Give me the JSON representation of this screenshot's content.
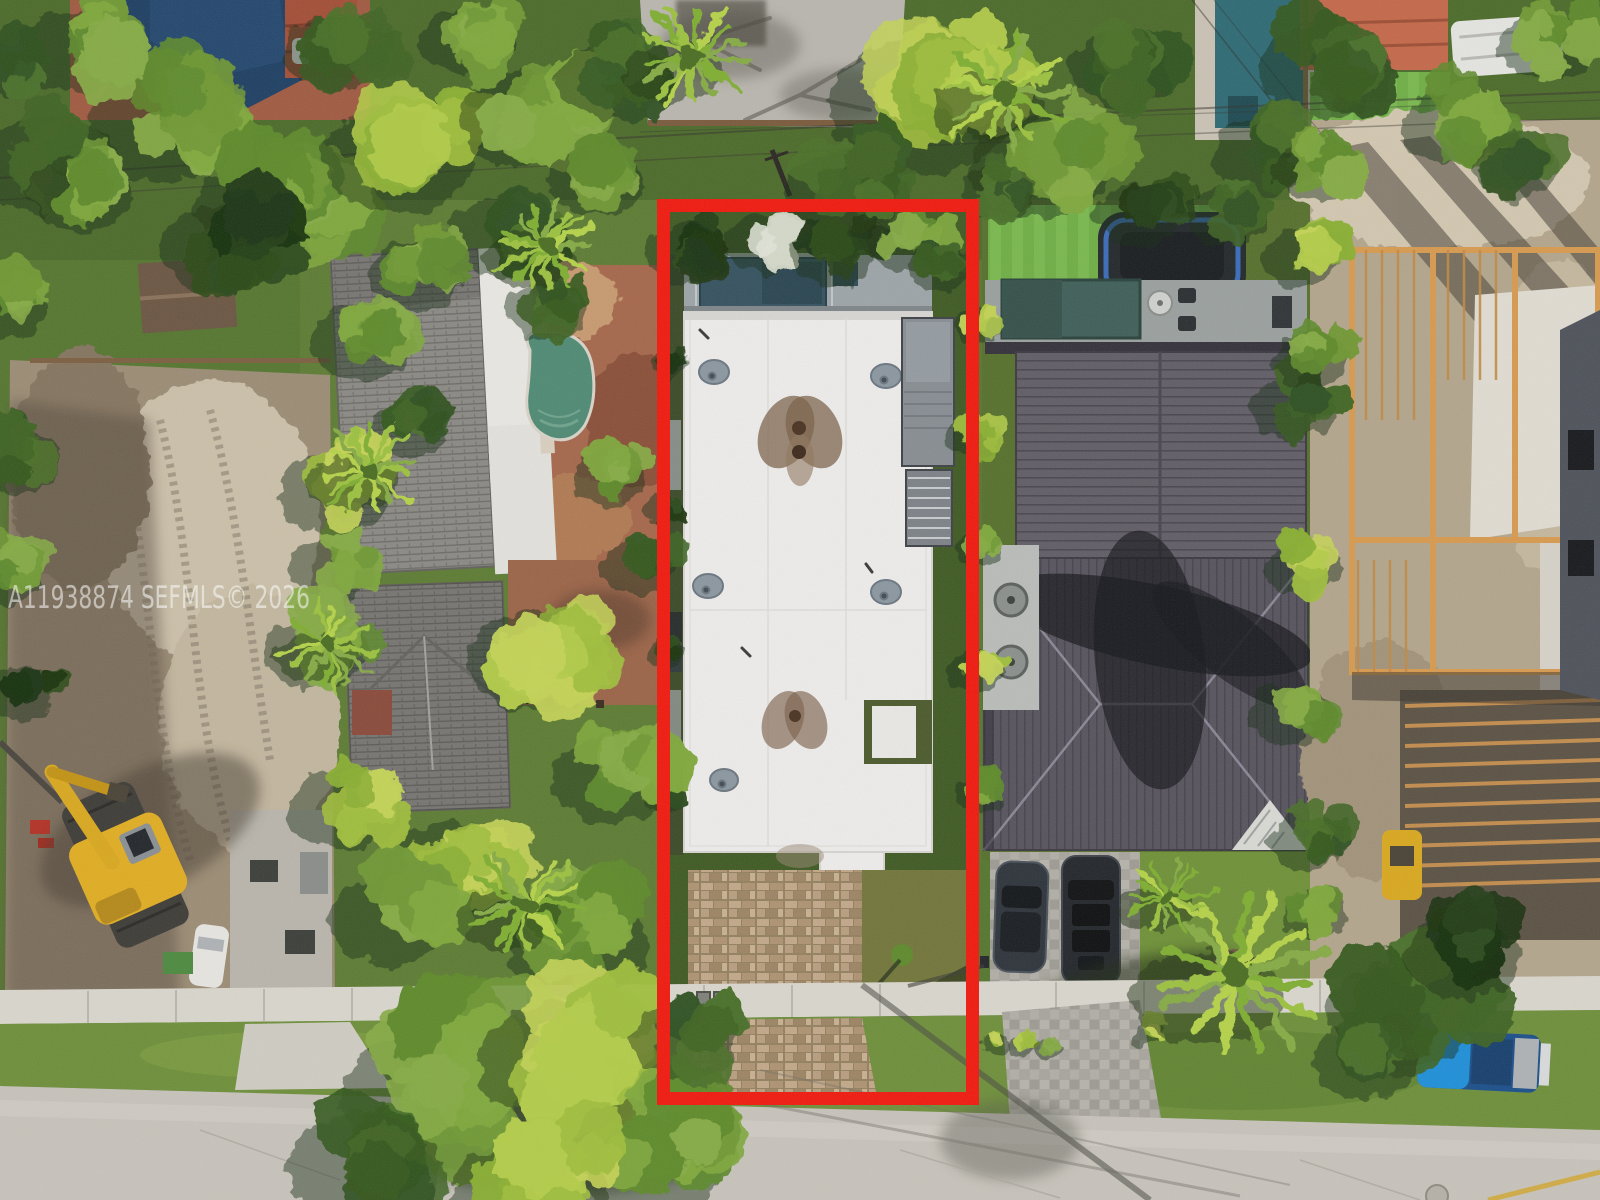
{
  "title": "Aerial drone photo of residential lot with highlighted property boundary",
  "watermark": {
    "text": "A11938874  SEFMLS© 2026",
    "color": "#ffffff"
  },
  "property_outline": {
    "color": "#f0190e",
    "shape": "rectangle"
  },
  "palette": {
    "street": "#c7c3bb",
    "sidewalk": "#d9d6cd",
    "white_roof": "#edecea",
    "metal_roof": "#5f5b64",
    "shingle_roof": "#8b8984",
    "pavers": "#b29a7e",
    "dirt": "#a5947c",
    "sand": "#cfc4ab",
    "lumber": "#d79a4f",
    "turf": "#6fae45",
    "pool_blue": "#1e3f63",
    "pool_teal": "#35525f",
    "pool_green": "#4f8a74",
    "excavator_yellow": "#e0ad22",
    "truck_blue": "#1f8fd8",
    "veg_bright": [
      "#9fbe3c",
      "#b3cc48",
      "#8aaf33",
      "#c4d356"
    ],
    "veg_mid": [
      "#6f9834",
      "#7fa83c",
      "#5e8a2c",
      "#86ab45"
    ],
    "veg_dark": [
      "#3f6424",
      "#2f5120",
      "#4a7029",
      "#35591f"
    ],
    "veg_deep": [
      "#243f17",
      "#1d3512",
      "#2c4a1a",
      "#16300f"
    ],
    "veg_pale": [
      "#c6ccb8",
      "#d4d9c9",
      "#b7bfa9",
      "#dfe3d6"
    ],
    "veg_palm": [
      "#9cc13f",
      "#b5d24a",
      "#7fae33",
      "#86ab45"
    ]
  }
}
